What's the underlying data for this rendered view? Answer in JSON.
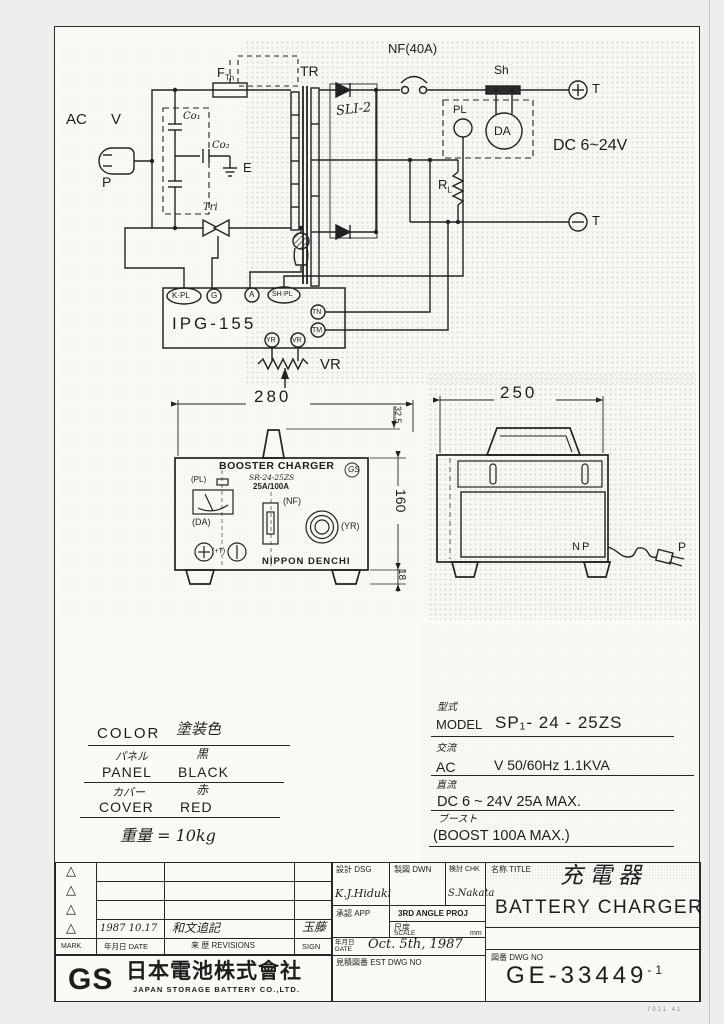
{
  "schematic": {
    "ac": "AC",
    "v": "V",
    "plug_label": "P",
    "fuse_base": "F",
    "fuse_sub": "Th",
    "cap1": "Co₁",
    "cap2": "Co₂",
    "ground": "E",
    "triac": "Tri",
    "transformer": "TR",
    "rectifier": "SLI-2",
    "breaker": "NF(40A)",
    "shunt": "Sh",
    "pilot_lamp": "PL",
    "ammeter": "DA",
    "dc_rating": "DC 6~24V",
    "t_plus": "T",
    "t_minus": "T",
    "rl_base": "R",
    "rl_sub": "L",
    "board": "IPG-155",
    "term_kpl": "K·PL",
    "term_g": "G",
    "term_a": "A",
    "term_shpl": "SH·PL",
    "term_tn": "TN",
    "term_tm": "TM",
    "term_yr": "YR",
    "term_vr": "VR",
    "pot": "VR"
  },
  "front_view": {
    "dim_width": "280",
    "dim_handle": "32.5",
    "dim_height": "160",
    "dim_feet": "18",
    "title": "BOOSTER CHARGER",
    "model": "SR-24-25ZS",
    "rating": "25A/100A",
    "logo": "GS",
    "lbl_pl": "(PL)",
    "lbl_da": "(DA)",
    "lbl_nf": "(NF)",
    "lbl_yr": "(YR)",
    "lbl_t": "(+T)",
    "brand": "NIPPON DENCHI"
  },
  "side_view": {
    "dim_width": "250",
    "lbl_np": "NP",
    "lbl_p": "P"
  },
  "color_table": {
    "en": "COLOR",
    "jp": "塗装色",
    "row1_jp": "パネル",
    "row1_jp_val": "黒",
    "row1_en": "PANEL",
    "row1_en_val": "BLACK",
    "row2_jp": "カバー",
    "row2_jp_val": "赤",
    "row2_en": "COVER",
    "row2_en_val": "RED",
    "weight": "重量 = 10kg"
  },
  "spec_table": {
    "model_jp": "型式",
    "model_en": "MODEL",
    "model_val": "SP₁- 24 - 25ZS",
    "ac_jp": "交流",
    "ac_en": "AC",
    "ac_val": "V 50/60Hz 1.1KVA",
    "dc_jp": "直流",
    "dc_val": "DC 6 ~ 24V  25A MAX.",
    "boost_jp": "ブースト",
    "boost_val": "(BOOST      100A MAX.)"
  },
  "revisions": {
    "mark": "MARK",
    "date_hdr": "年月日 DATE",
    "rev_hdr": "来 歴 REVISIONS",
    "sign_hdr": "SIGN",
    "entry_date": "1987 10.17",
    "entry_text": "和文追記",
    "entry_sign": "玉藤",
    "tri": "△"
  },
  "company": {
    "logo": "GS",
    "jp": "日本電池株式會社",
    "en": "JAPAN STORAGE BATTERY CO.,LTD."
  },
  "title_block": {
    "dsg": "設計 DSG",
    "dwn": "製図 DWN",
    "chk": "検討 CHK",
    "app": "承認 APP",
    "dsg_sign": "K.J.Hiduki",
    "chk_sign": "S.Nakata",
    "proj": "3RD ANGLE PROJ",
    "scale_jp": "尺度",
    "scale_en": "SCALE",
    "unit": "mm",
    "date_jp": "年月日",
    "date_en": "DATE",
    "date_val": "Oct. 5th, 1987",
    "est": "見積図番 EST DWG NO",
    "title_lbl": "名称 TITLE",
    "title_jp": "充電器",
    "title_en": "BATTERY CHARGER",
    "dwg_lbl": "図番 DWG NO",
    "dwg_no": "GE-33449",
    "dwg_sup": "-1"
  },
  "corner_mark": "7011 41"
}
